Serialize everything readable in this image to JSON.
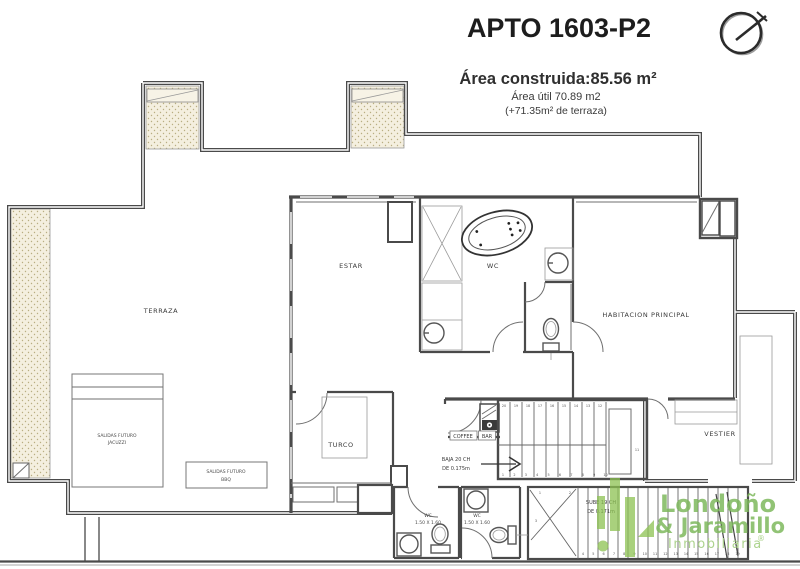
{
  "header": {
    "title": "APTO 1603-P2",
    "area_construida": "Área construida:85.56 m²",
    "area_util": "Área útil 70.89 m2",
    "area_terraza": "(+71.35m²  de terraza)"
  },
  "compass": {
    "icon": "north-indicator"
  },
  "rooms": {
    "terraza": "TERRAZA",
    "estar": "ESTAR",
    "wc_principal": "WC",
    "habitacion": "HABITACION PRINCIPAL",
    "turco": "TURCO",
    "vestier": "VESTIER"
  },
  "labels": {
    "jacuzzi_1": "SALIDAS FUTURO",
    "jacuzzi_2": "JACUZZI",
    "bbq_1": "SALIDAS FUTURO",
    "bbq_2": "BBQ",
    "baja_1": "BAJA  20 CH",
    "baja_2": "DE 0.175m",
    "sube_1": "SUBE  19 CH",
    "sube_2": "DE 0.171m",
    "coffee": "COFFEE",
    "bar": "BAR",
    "wc1": "WC",
    "wc1_dim": "1.50 X 1.60",
    "wc2": "WC",
    "wc2_dim": "1.50 X 1.60"
  },
  "stairs": {
    "upper_top": [
      "20",
      "19",
      "18",
      "17",
      "16",
      "15",
      "14",
      "13",
      "12"
    ],
    "upper_bottom": [
      "1",
      "2",
      "3",
      "4",
      "5",
      "6",
      "7",
      "8",
      "9",
      "10"
    ],
    "upper_landing": "11",
    "winder_1": "1",
    "winder_2": "2",
    "winder_3": "3",
    "lower": [
      "4",
      "5",
      "6",
      "7",
      "8",
      "9",
      "10",
      "11",
      "12",
      "13",
      "14",
      "15",
      "16",
      "17",
      "18",
      "19"
    ]
  },
  "logo": {
    "line1": "Londoño",
    "line2": "& Jaramillo",
    "line3": "Inmobiliaria",
    "registered": "®",
    "green": "#8cc152",
    "light_green": "#a9d189"
  },
  "colors": {
    "wall": "#4a4a4a",
    "line": "#6f6f6f",
    "planter_fill": "#f4efdf",
    "planter_dot": "#b9ae82",
    "text": "#3a3a3a",
    "title": "#1d1d1d"
  }
}
